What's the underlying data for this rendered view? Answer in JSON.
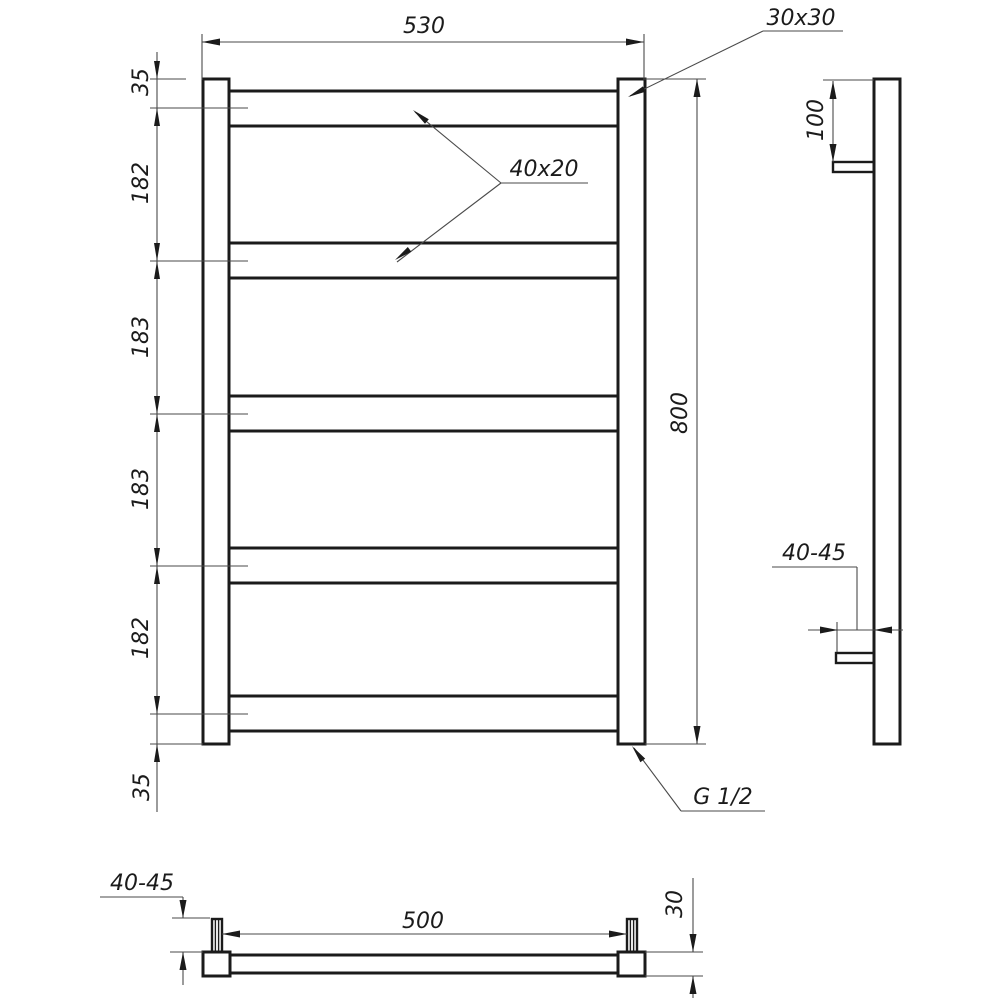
{
  "front_view": {
    "overall_width": "530",
    "overall_height": "800",
    "post_profile": "30x30",
    "rung_profile": "40x20",
    "connection_thread": "G 1/2",
    "rung_spacing": [
      "35",
      "182",
      "183",
      "183",
      "182",
      "35"
    ]
  },
  "side_view": {
    "bracket_top_offset": "100",
    "wall_clearance": "40-45"
  },
  "bottom_view": {
    "bracket_span": "500",
    "profile_depth": "30",
    "wall_clearance": "40-45"
  },
  "colors": {
    "line": "#1b1b1b",
    "thin_line": "#4a4a4a",
    "background": "#ffffff"
  }
}
